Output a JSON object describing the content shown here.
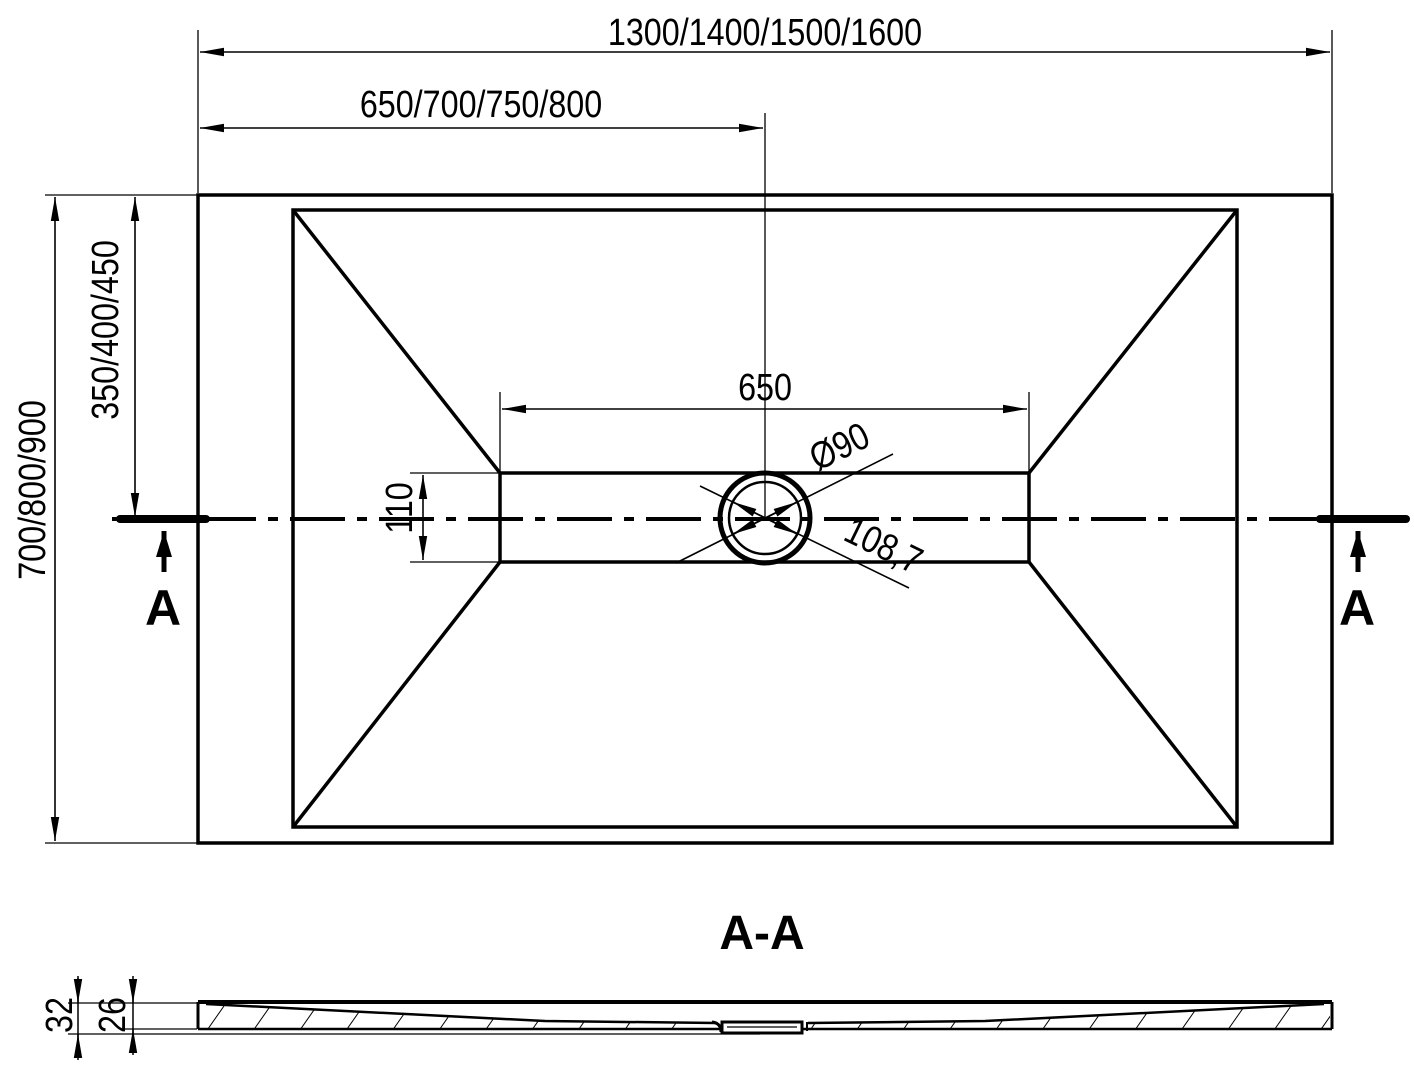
{
  "drawing": {
    "plan": {
      "dim_overall_width": "1300/1400/1500/1600",
      "dim_offset_width": "650/700/750/800",
      "dim_overall_depth": "700/800/900",
      "dim_offset_depth": "350/400/450",
      "dim_channel_length": "650",
      "dim_channel_width": "110",
      "dim_drain_diameter": "Ø90",
      "dim_drain_diagonal": "108,7",
      "section_marker_left": "A",
      "section_marker_right": "A"
    },
    "section": {
      "title": "A-A",
      "dim_total_height": "32",
      "dim_inner_height": "26"
    },
    "colors": {
      "line": "#000000",
      "background": "#ffffff"
    }
  }
}
